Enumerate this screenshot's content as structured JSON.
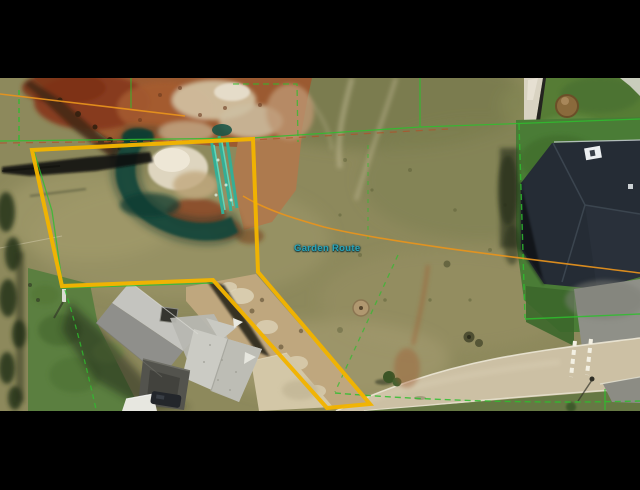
{
  "map": {
    "road_label": "Garden Route",
    "colors": {
      "boundary": "#f2b400",
      "parcel_line": "#2ebe2e",
      "parcel_line_alt": "#b0512a",
      "route_line": "#e8941c",
      "label_text": "#2aa4b8",
      "letterbox": "#000000"
    }
  }
}
